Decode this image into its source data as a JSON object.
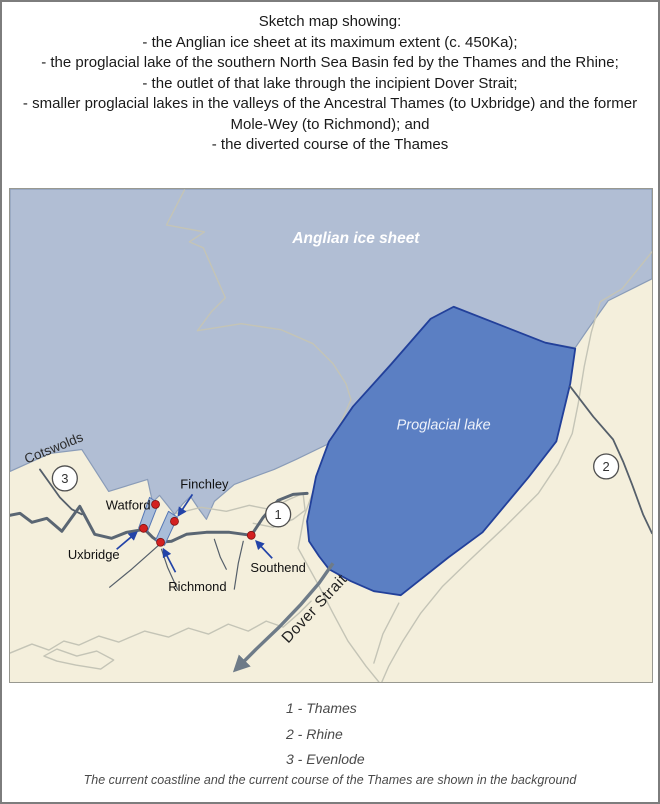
{
  "title": {
    "heading": "Sketch map showing:",
    "bullets": [
      "- the Anglian ice sheet at its maximum extent (c. 450Ka);",
      "- the proglacial lake of the southern North Sea Basin fed by the Thames and the Rhine;",
      "- the outlet of that lake through the incipient Dover Strait;",
      "- smaller proglacial lakes in the valleys of the Ancestral Thames (to Uxbridge) and the former Mole-Wey (to Richmond); and",
      "- the diverted course of the Thames"
    ]
  },
  "map": {
    "labels": {
      "ice_sheet": "Anglian ice sheet",
      "lake": "Proglacial lake",
      "cotswolds": "Cotswolds",
      "dover_strait": "Dover Strait"
    },
    "places": {
      "watford": "Watford",
      "finchley": "Finchley",
      "uxbridge": "Uxbridge",
      "richmond": "Richmond",
      "southend": "Southend"
    },
    "river_numbers": [
      "1",
      "2",
      "3"
    ]
  },
  "legend": {
    "items": [
      "1 - Thames",
      "2 - Rhine",
      "3 - Evenlode"
    ],
    "note": "The current coastline and the current course of the Thames are shown in the background"
  },
  "colors": {
    "land": "#f4efdc",
    "ice": "#b1bed4",
    "ice_edge": "#8a9cb8",
    "lake": "#5b7fc3",
    "lake_edge": "#22409a",
    "valley_lake": "#a9bdd9",
    "valley_edge": "#5577b5",
    "coast": "#c4c4b6",
    "river_main": "#5a6673",
    "river_thin": "#555f6a",
    "outflow": "#6e7b88",
    "marker_red": "#d32020",
    "arrow_blue": "#2243a8"
  }
}
